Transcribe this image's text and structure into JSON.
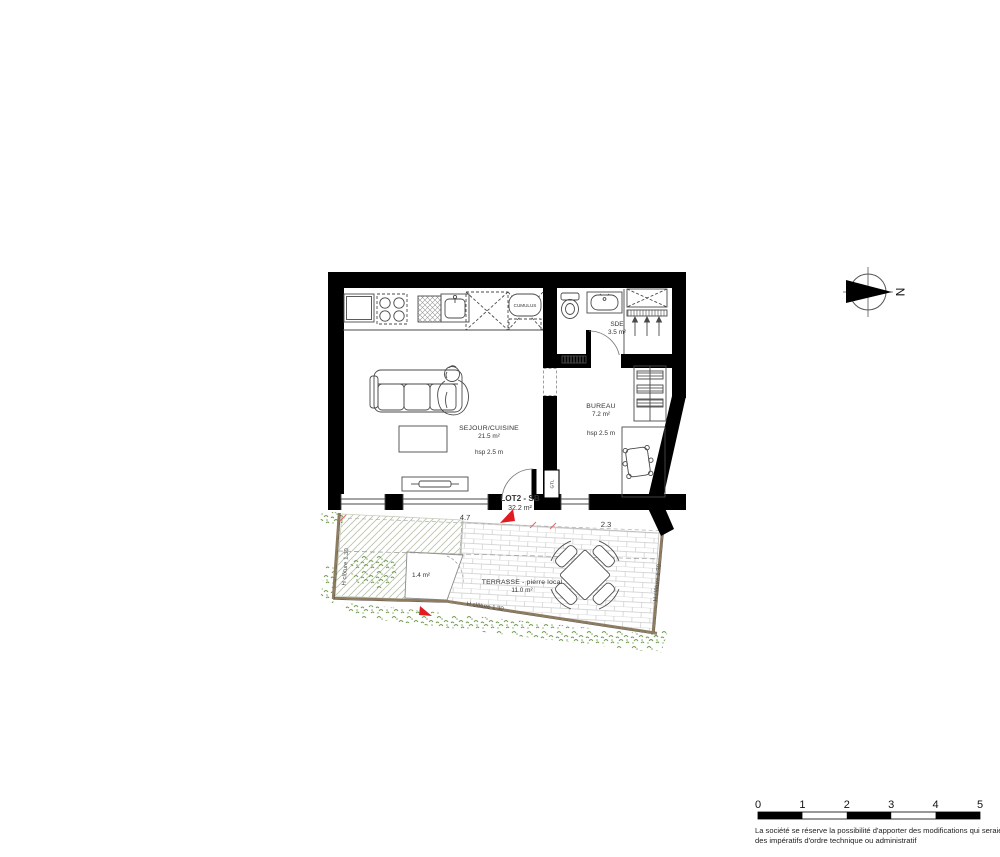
{
  "plan": {
    "title": "floor plan LOT2 - SB",
    "lot": {
      "id": "LOT2 - SB",
      "area": "32.2 m²"
    },
    "rooms": {
      "sejour": {
        "name": "SEJOUR/CUISINE",
        "area": "21.5 m²",
        "ceiling": "hsp 2.5 m"
      },
      "bureau": {
        "name": "BUREAU",
        "area": "7.2 m²",
        "ceiling": "hsp 2.5 m"
      },
      "sde": {
        "name": "SDE",
        "area": "3.5 m²"
      },
      "terrasse": {
        "name": "TERRASSE - pierre local",
        "area": "11.0 m²"
      },
      "garden_plot": {
        "area": "1.4 m²"
      }
    },
    "equipment": {
      "cumulus": "CUMULUS",
      "gtl": "GTL"
    },
    "dimensions": {
      "sejour_width": "4.7",
      "bureau_width": "2.3"
    },
    "fence": {
      "label": "H clôture 1.30"
    },
    "compass": {
      "north": "N"
    }
  },
  "scale_bar": {
    "labels": [
      "0",
      "1",
      "2",
      "3",
      "4",
      "5"
    ]
  },
  "disclaimer": {
    "line1": "La société se réserve la possibilité d'apporter des modifications qui seraient  dues à",
    "line2": "des impératifs d'ordre technique ou administratif"
  },
  "colors": {
    "wall": "#000000",
    "line": "#4a4a4a",
    "accent_red": "#e01b22",
    "dim_red": "#e06a6a",
    "fence_brown": "#8d7b5f",
    "vegetation_green": "#6f9a4f",
    "hatch_green": "#b9c4ab",
    "paving_gray": "#cccccc"
  }
}
